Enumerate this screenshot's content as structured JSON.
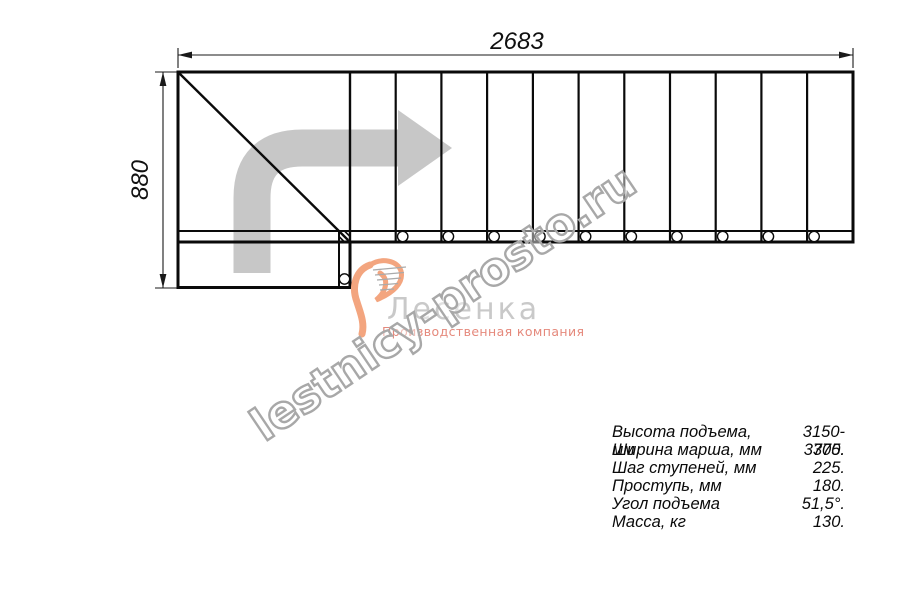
{
  "dimensions": {
    "width_mm": "2683",
    "height_mm": "880"
  },
  "watermark": "lestnicy-prosto.ru",
  "logo": {
    "name": "Лесенка",
    "tagline": "Производственная компания"
  },
  "specs": [
    {
      "label": "Высота подъема, мм",
      "value": "3150-3375."
    },
    {
      "label": "Ширина марша, мм",
      "value": "700."
    },
    {
      "label": "Шаг ступеней, мм",
      "value": "225."
    },
    {
      "label": "Проступь, мм",
      "value": "180."
    },
    {
      "label": "Угол подъема",
      "value": "51,5°."
    },
    {
      "label": "Масса, кг",
      "value": "130."
    }
  ],
  "colors": {
    "line": "#0a0a0a",
    "direction_arrow": "#c7c7c7",
    "watermark_stroke": "#a8a8a8",
    "logo_name": "#c9c9c9",
    "logo_accent": "#f3a57f",
    "logo_tagline": "#e5897c"
  },
  "figure": {
    "type": "staircase-plan-top-view",
    "step_lines": 12,
    "landing": "bottom-left"
  }
}
